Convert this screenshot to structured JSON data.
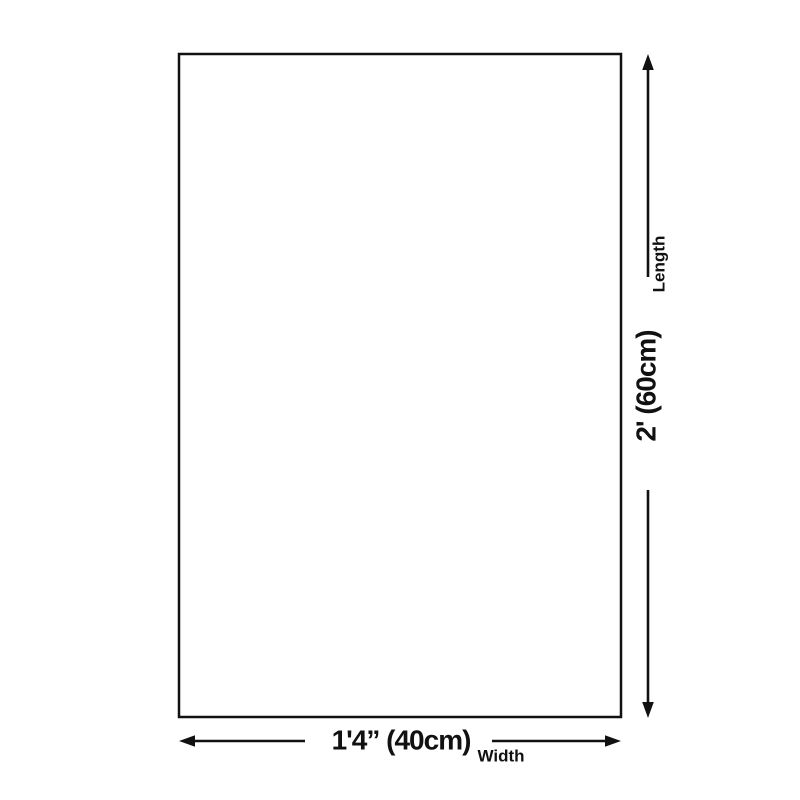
{
  "colors": {
    "background": "#ffffff",
    "line": "#111111",
    "text": "#111111"
  },
  "dimensions": {
    "width": {
      "value": "1'4” (40cm)",
      "label": "Width"
    },
    "length": {
      "value": "2' (60cm)",
      "label": "Length"
    }
  }
}
